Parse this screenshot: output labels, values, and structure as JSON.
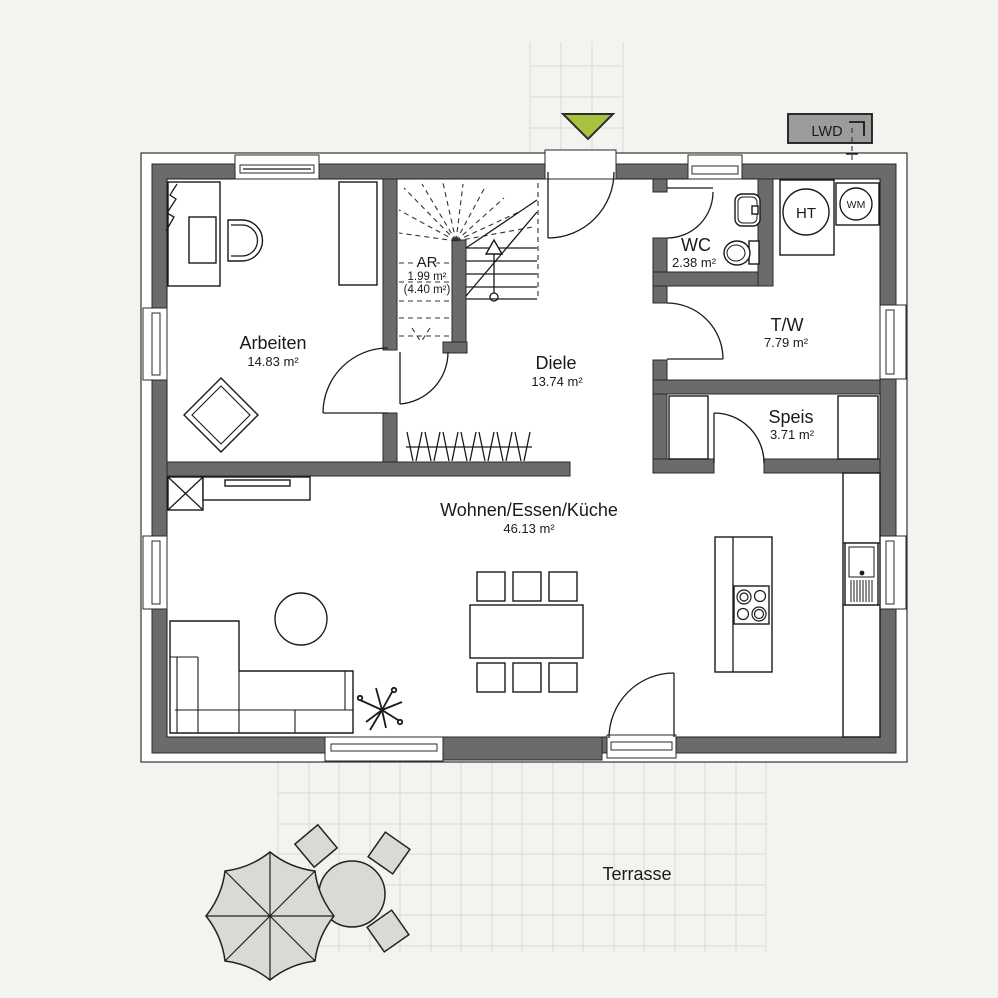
{
  "rooms": {
    "arbeiten": {
      "name": "Arbeiten",
      "area": "14.83 m²"
    },
    "ar": {
      "name": "AR",
      "area": "1.99 m²",
      "area_total": "(4.40 m²)"
    },
    "diele": {
      "name": "Diele",
      "area": "13.74 m²"
    },
    "wc": {
      "name": "WC",
      "area": "2.38 m²"
    },
    "tw": {
      "name": "T/W",
      "area": "7.79 m²"
    },
    "speis": {
      "name": "Speis",
      "area": "3.71 m²"
    },
    "wohnen": {
      "name": "Wohnen/Essen/Küche",
      "area": "46.13 m²"
    },
    "terrasse": {
      "name": "Terrasse"
    }
  },
  "equipment": {
    "lwd_label": "LWD",
    "ht_label": "HT",
    "wm_label": "WM"
  },
  "colors": {
    "wall": "#6b6b6b",
    "background": "#f4f3f0",
    "entrance_marker": "#a8c23f",
    "outdoor_furniture": "#d9d9d6",
    "grid_line": "#d9d8d4",
    "lwd_box": "#9c9c9c"
  }
}
